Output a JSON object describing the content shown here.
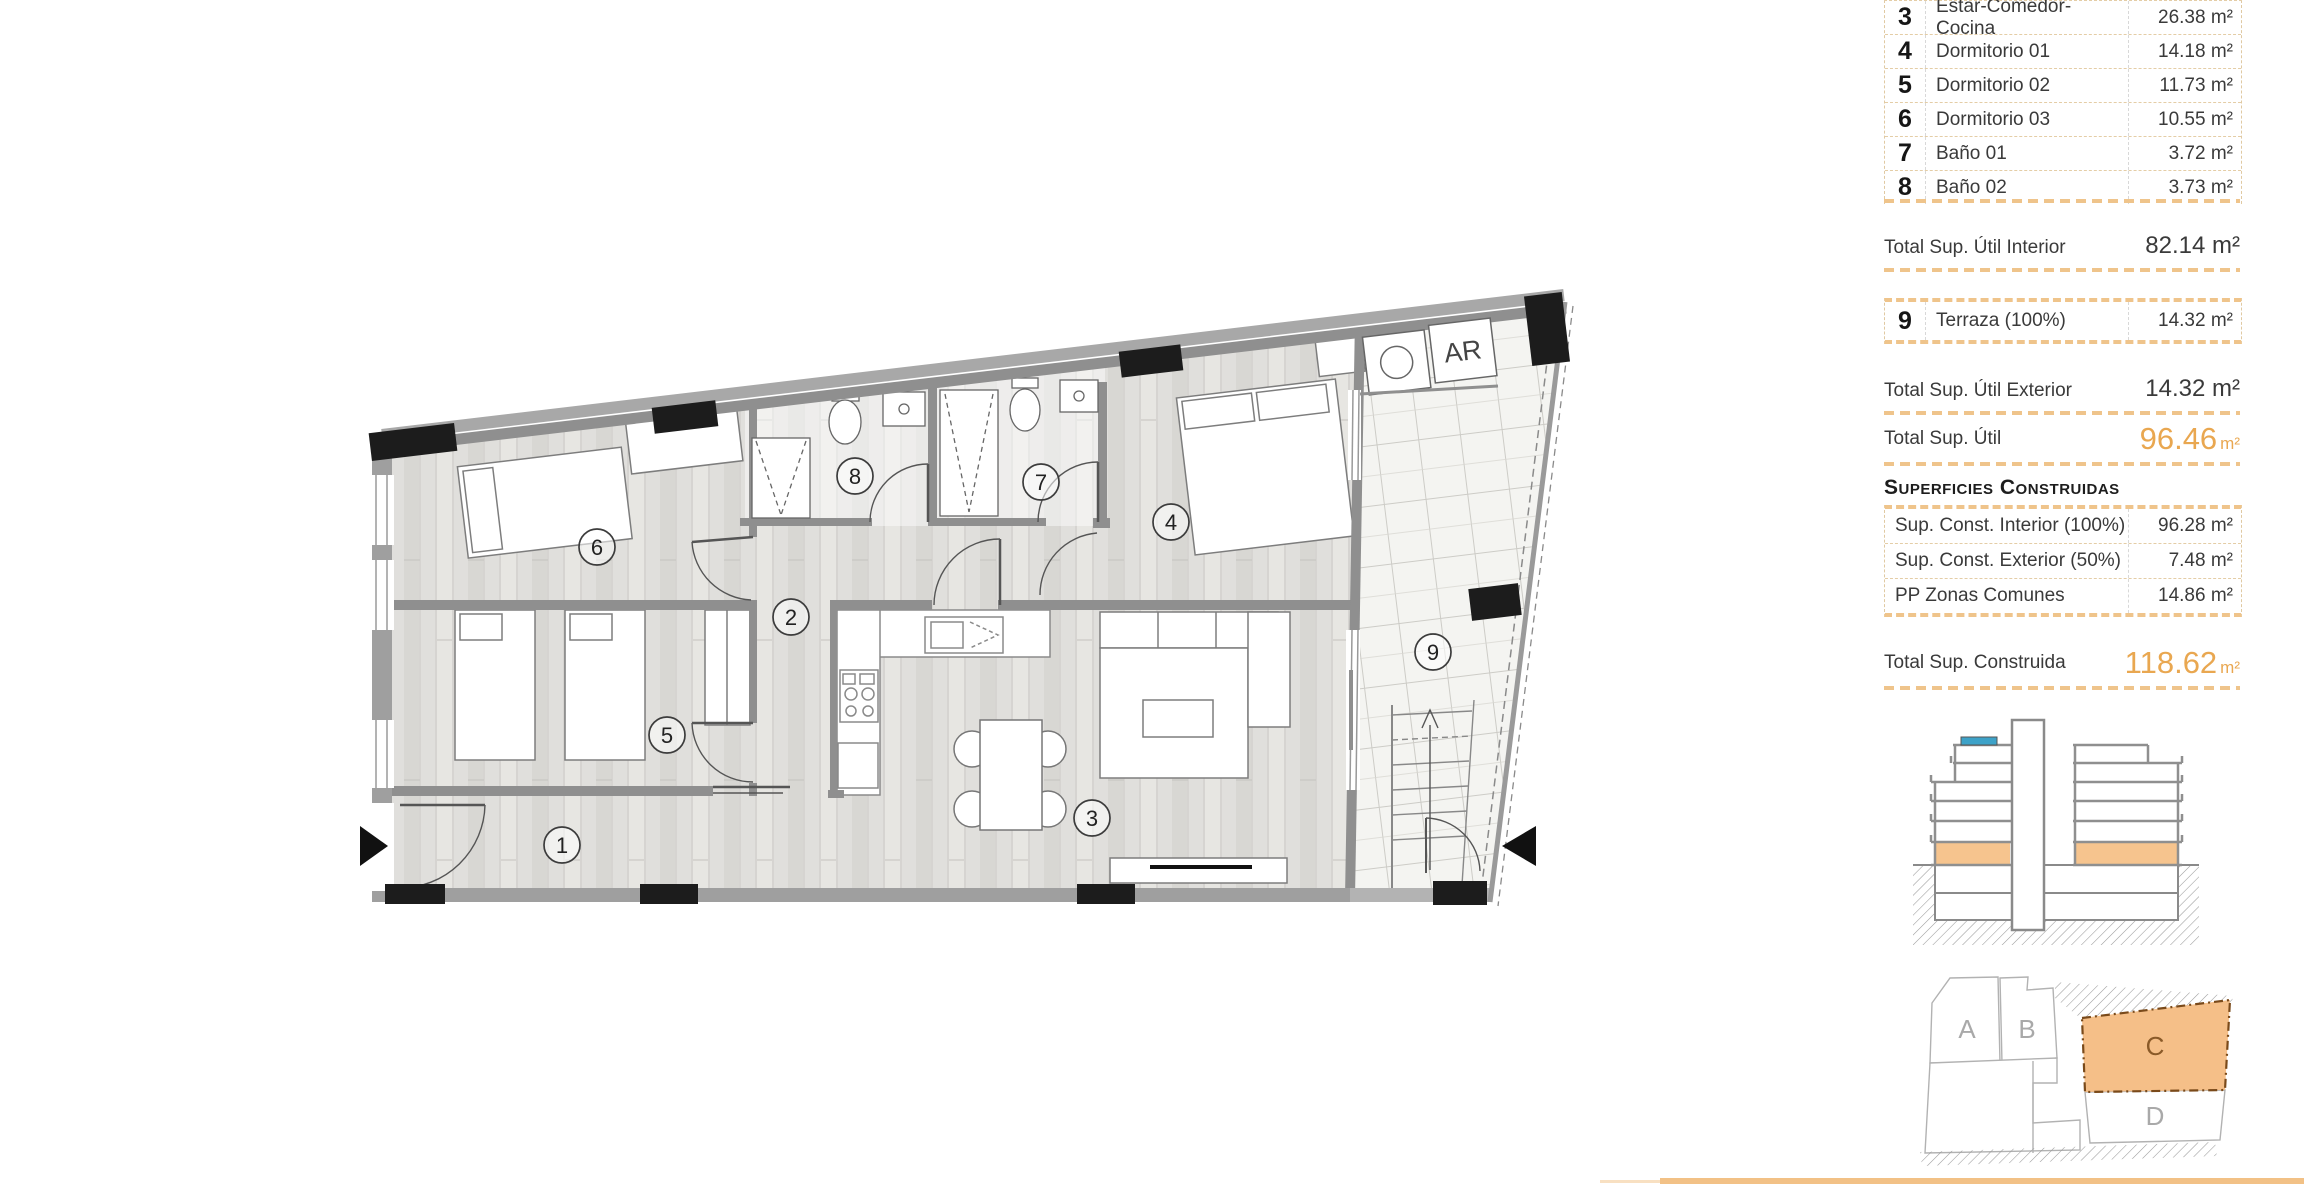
{
  "colors": {
    "accent_orange": "#e9a750",
    "dash_tan": "#efc48b",
    "highlight_fill": "#f6c48e",
    "pool_blue": "#3da2c8",
    "wall_gray": "#8f8f8f"
  },
  "legend": {
    "rooms": [
      {
        "num": "3",
        "name": "Estar-Comedor-Cocina",
        "area": "26.38 m²"
      },
      {
        "num": "4",
        "name": "Dormitorio 01",
        "area": "14.18 m²"
      },
      {
        "num": "5",
        "name": "Dormitorio 02",
        "area": "11.73 m²"
      },
      {
        "num": "6",
        "name": "Dormitorio 03",
        "area": "10.55 m²"
      },
      {
        "num": "7",
        "name": "Baño 01",
        "area": "3.72 m²"
      },
      {
        "num": "8",
        "name": "Baño 02",
        "area": "3.73 m²"
      }
    ],
    "totals": {
      "util_interior": {
        "label": "Total Sup. Útil Interior",
        "value": "82.14 m²"
      },
      "terraza": {
        "num": "9",
        "name": "Terraza (100%)",
        "area": "14.32 m²"
      },
      "util_exterior": {
        "label": "Total Sup. Útil Exterior",
        "value": "14.32 m²"
      },
      "util_total": {
        "label": "Total Sup. Útil",
        "value": "96.46",
        "unit": "m²"
      }
    },
    "construidas": {
      "title": "Superficies Construidas",
      "rows": [
        {
          "label": "Sup. Const. Interior (100%)",
          "value": "96.28 m²"
        },
        {
          "label": "Sup. Const. Exterior (50%)",
          "value": "7.48 m²"
        },
        {
          "label": "PP Zonas Comunes",
          "value": "14.86 m²"
        }
      ],
      "total": {
        "label": "Total Sup. Construida",
        "value": "118.62",
        "unit": "m²"
      }
    }
  },
  "plan": {
    "room_numbers": [
      "1",
      "2",
      "3",
      "4",
      "5",
      "6",
      "7",
      "8",
      "9"
    ],
    "ar_label": "AR"
  },
  "site": {
    "blocks": [
      "A",
      "B",
      "C",
      "D"
    ]
  }
}
